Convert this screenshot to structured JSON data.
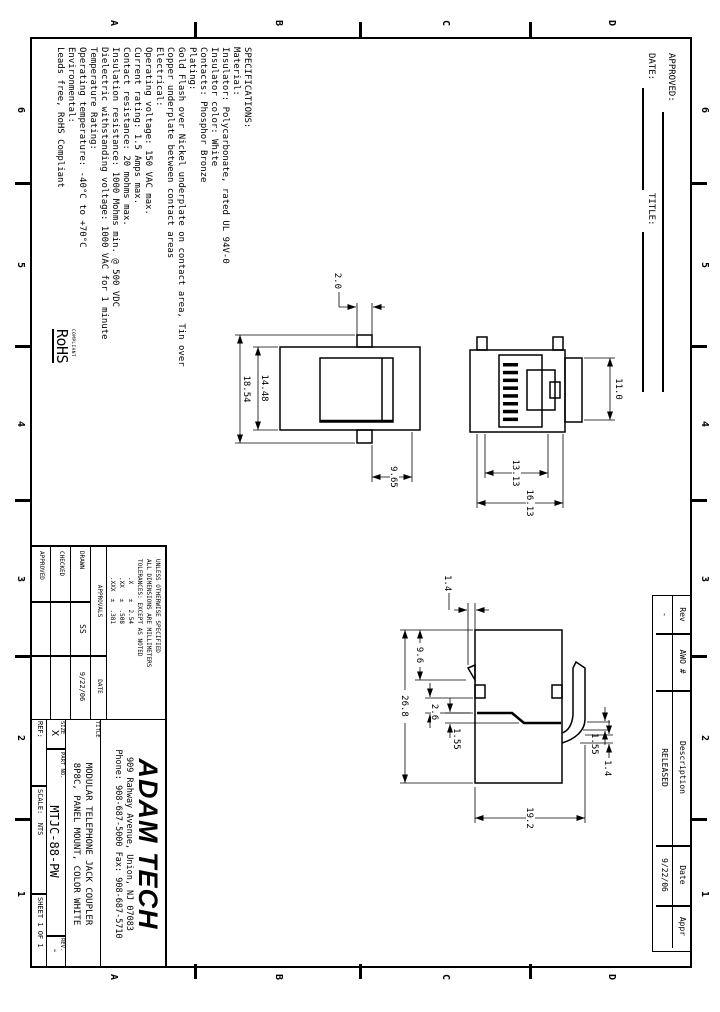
{
  "zones": {
    "cols": [
      "6",
      "5",
      "4",
      "3",
      "2",
      "1"
    ],
    "rows": [
      "D",
      "C",
      "B",
      "A"
    ]
  },
  "header": {
    "approved": "APPROVED:",
    "date": "DATE:",
    "title": "TITLE:"
  },
  "rev_table": {
    "col_rev": "Rev",
    "col_awo": "AWO #",
    "col_desc": "Description",
    "col_date": "Date",
    "col_appr": "Appr",
    "rev": "-",
    "awo": "",
    "desc": "RELEASED",
    "date": "9/22/06",
    "appr": ""
  },
  "specs_lines": [
    "SPECIFICATIONS:",
    "Material:",
    "Insulator: Polycarbonate, rated UL 94V-0",
    "Insulator color: White",
    "Contacts: Phosphor Bronze",
    "Plating:",
    "Gold Flash over Nickel underplate on contact area, Tin over",
    "Copper underplate between contact areas",
    "Electrical:",
    "Operating voltage: 150 VAC max.",
    "Current rating: 1.5 Amps max.",
    "Contact resistance: 20 mohms max.",
    "Insulation resistance: 1000 Mohms min. @ 500 VDC",
    "Dielectric withstanding voltage: 1000 VAC for 1 minute",
    "Temperature Rating:",
    "Operating temperature: -40°C to +70°C",
    "Environmental:",
    "Leads free, RoHS Compliant"
  ],
  "rohs": {
    "top": "COMPLIANT",
    "main": "RoHS"
  },
  "tol_lines": [
    "UNLESS OTHERWISE SPECIFIED",
    "ALL DIMENSIONS ARE MILLIMETERS",
    "TOLERANCES: EXCEPT AS NOTED",
    ".X    ±  2.54",
    ".XX   ±  .508",
    ".XXX  ±  .381"
  ],
  "approvals": {
    "header": "APPROVALS",
    "date_header": "DATE",
    "r1": {
      "label": "DRAWN",
      "by": "SS",
      "date": "9/22/06"
    },
    "r2": {
      "label": "CHECKED",
      "by": "",
      "date": ""
    },
    "r3": {
      "label": "APPROVED",
      "by": "",
      "date": ""
    }
  },
  "company": {
    "name": "ADAM TECH",
    "addr1": "909 Rahway Avenue, Union, NJ 07083",
    "addr2": "Phone: 908-687-5000 Fax: 908-687-5710"
  },
  "titleblock": {
    "title_label": "TITLE",
    "title1": "MODULAR TELEPHONE JACK COUPLER",
    "title2": "8P8C, PANEL MOUNT, COLOR WHITE",
    "size_label": "SIZE",
    "size": "X",
    "part_label": "PART NO.",
    "part": "MTJC-88-PW",
    "rev_label": "REV.",
    "rev": "-",
    "ref_label": "REF:",
    "scale_label": "SCALE:  NTS",
    "sheet_label": "SHEET 1 OF 1"
  },
  "dims": {
    "rear": {
      "tab": "2.0",
      "body_w": "14.48",
      "total_w": "18.54",
      "side": "9.65"
    },
    "front": {
      "top_w": "11.0",
      "inner_h": "13.13",
      "outer_h": "16.13"
    },
    "side": {
      "hook": "1.4",
      "edge_hook": "9.6",
      "gap": "2.6",
      "step": "1.55",
      "width": "26.8",
      "tip": "1.55",
      "arm": "1.4",
      "height": "19.2"
    }
  }
}
